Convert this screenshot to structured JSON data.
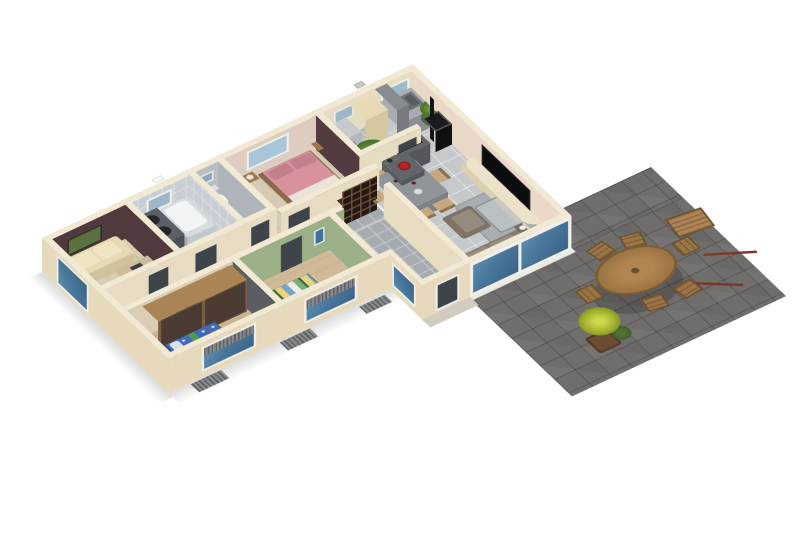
{
  "scene": {
    "kind": "isometric-3d-floor-plan-render",
    "background": "#ffffff",
    "view": "cutaway dollhouse view of a single-storey house with exterior terrace"
  },
  "palette": {
    "wallTop": "#f1e9d3",
    "wallBeige": "#e7dcc2",
    "wallBeigeOuter": "#e6d9bc",
    "wallMaroon": "#503a3d",
    "wallMaroon2": "#533b3f",
    "wallGreen": "#9cb089",
    "wallPinkBeige": "#ddccbf",
    "bathTileWall": "#c9ced4",
    "tileLight": "#c5c9cb",
    "tileMid": "#a6abaf",
    "tileDark": "#63686e",
    "tileUtility": "#b9bcbe",
    "woodFloor1": "#d8ccb2",
    "woodFloor2": "#cab491",
    "woodFloor3": "#cfb996",
    "woodFloorMaster": "#d6cab2",
    "terraceTile": "#6f6e6c",
    "porch": "#d2ccc0",
    "sill": "#eceae4",
    "glassBlue": "#47769a",
    "frameWhite": "#f0efe9",
    "shutterGray": "#87898c",
    "doorDark": "#3f444a",
    "bedPink": "#d8929b",
    "pillowPink": "#c27f8c",
    "bedFrameWood": "#8a6a4a",
    "bedBlue": "#3f6cb8",
    "kid2StripeGreen": "#7fae7a",
    "sofaCream": "#e5dab4",
    "sofaTaupe": "#867b6e",
    "cushionTaupe": "#9a8d7d",
    "armchair": "#7d7367",
    "rugGray": "#a8adb0",
    "coffeeGlass": "rgba(190,198,202,.75)",
    "diningTable": "#8f9499",
    "chairWood": "#c6a87c",
    "islandGray": "#616569",
    "counterGray": "#a9adb1",
    "tallCabGray": "#888c90",
    "hobBlack": "#1d1f22",
    "bowlRed": "#b5242b",
    "fridgeCream": "#e7dbb5",
    "washerGray": "#c7cacc",
    "wardrobeWood": "#aa8455",
    "wardrobeDoors": "#4b3b32",
    "closetWood": "#c2a87d",
    "cubbyBrown": "#3c2c22",
    "tvBlack": "#0c0d0f",
    "consoleCream": "#ece2c9",
    "stoveBlack": "#1a1b1d",
    "tubWhite": "#f2f5f6",
    "tubRim": "#d7dcdf",
    "vanityGray": "#5b6066",
    "toiletWhite": "#edf0f1",
    "radiatorGray": "#8e9296",
    "patioWood": "#a8804e",
    "patioChairWood": "#9b7546",
    "benchWood": "#ad8455",
    "plantGreen": "#4f7a2e",
    "plantYellow": "#b9c433",
    "potBrown": "#6e4c33",
    "paintingGreen": "#5c7140",
    "stickBrown": "#7b3a27"
  },
  "rooms": [
    {
      "id": "office",
      "name": "office-guest-room",
      "furniture": [
        "cream-sofa",
        "wall-painting",
        "desk",
        "desk-chair"
      ]
    },
    {
      "id": "bathroom",
      "name": "bathroom",
      "furniture": [
        "bathtub",
        "double-sink-vanity",
        "window"
      ]
    },
    {
      "id": "wc",
      "name": "toilet-room",
      "furniture": [
        "toilet"
      ]
    },
    {
      "id": "master-bedroom",
      "name": "master-bedroom",
      "furniture": [
        "double-bed-pink",
        "nightstand",
        "nightstand",
        "cubby-shelf",
        "window"
      ]
    },
    {
      "id": "utility",
      "name": "utility-room",
      "furniture": [
        "washing-machine",
        "tall-cream-unit"
      ]
    },
    {
      "id": "kitchen",
      "name": "kitchen",
      "furniture": [
        "counter-with-sink",
        "tall-cabinet",
        "island-with-hob",
        "red-bowl",
        "plants"
      ]
    },
    {
      "id": "living-dining",
      "name": "living-dining-room",
      "furniture": [
        "dining-table",
        "six-chairs",
        "gray-rug",
        "glass-coffee-table",
        "armchair",
        "sofa",
        "tv-flatscreen",
        "tv-console",
        "wood-stove",
        "wine-cubby-shelf"
      ]
    },
    {
      "id": "hallway",
      "name": "hallway",
      "furniture": [
        "wood-closets"
      ]
    },
    {
      "id": "entry",
      "name": "entry-hall",
      "furniture": [
        "front-door",
        "glazed-side-panel"
      ]
    },
    {
      "id": "kids-bedroom-1",
      "name": "kids-bedroom-blue",
      "furniture": [
        "kid-bed-blue-pattern",
        "wardrobe-dark-doors",
        "radiator",
        "kite-toy"
      ]
    },
    {
      "id": "kids-bedroom-2",
      "name": "kids-bedroom-green",
      "furniture": [
        "kid-bed-striped",
        "radiator",
        "wall-poster"
      ]
    },
    {
      "id": "terrace",
      "name": "terrace",
      "furniture": [
        "oval-patio-table",
        "patio-chairs",
        "bench",
        "planter-yellow-plant",
        "parasol-sticks"
      ]
    }
  ],
  "exterior": {
    "facade_features": [
      "beige-stucco-walls",
      "blue-glazed-sliding-doors",
      "white-window-frames",
      "gray-roller-shutters",
      "porch-slab",
      "white-sill-band",
      "rooftop-vent-caps"
    ]
  }
}
